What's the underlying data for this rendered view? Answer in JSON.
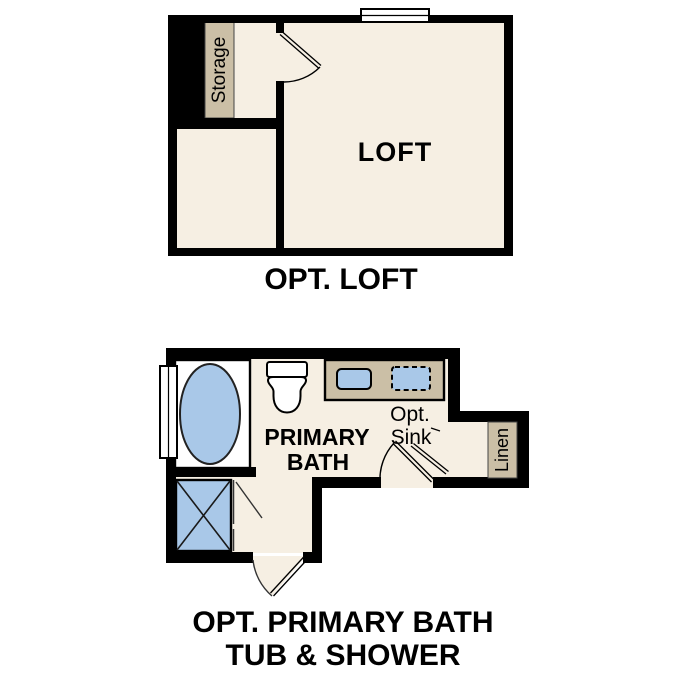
{
  "colors": {
    "floor": "#f6efe3",
    "wall": "#000000",
    "cabinet": "#cbbfa6",
    "fixture_blue": "#a9c8e8",
    "white": "#ffffff"
  },
  "loft_plan": {
    "storage_label": "Storage",
    "room_label": "LOFT",
    "caption": "OPT. LOFT"
  },
  "bath_plan": {
    "room_label_line1": "PRIMARY",
    "room_label_line2": "BATH",
    "opt_sink_label_line1": "Opt.",
    "opt_sink_label_line2": "Sink",
    "linen_label": "Linen",
    "caption_line1": "OPT. PRIMARY BATH",
    "caption_line2": "TUB & SHOWER"
  }
}
